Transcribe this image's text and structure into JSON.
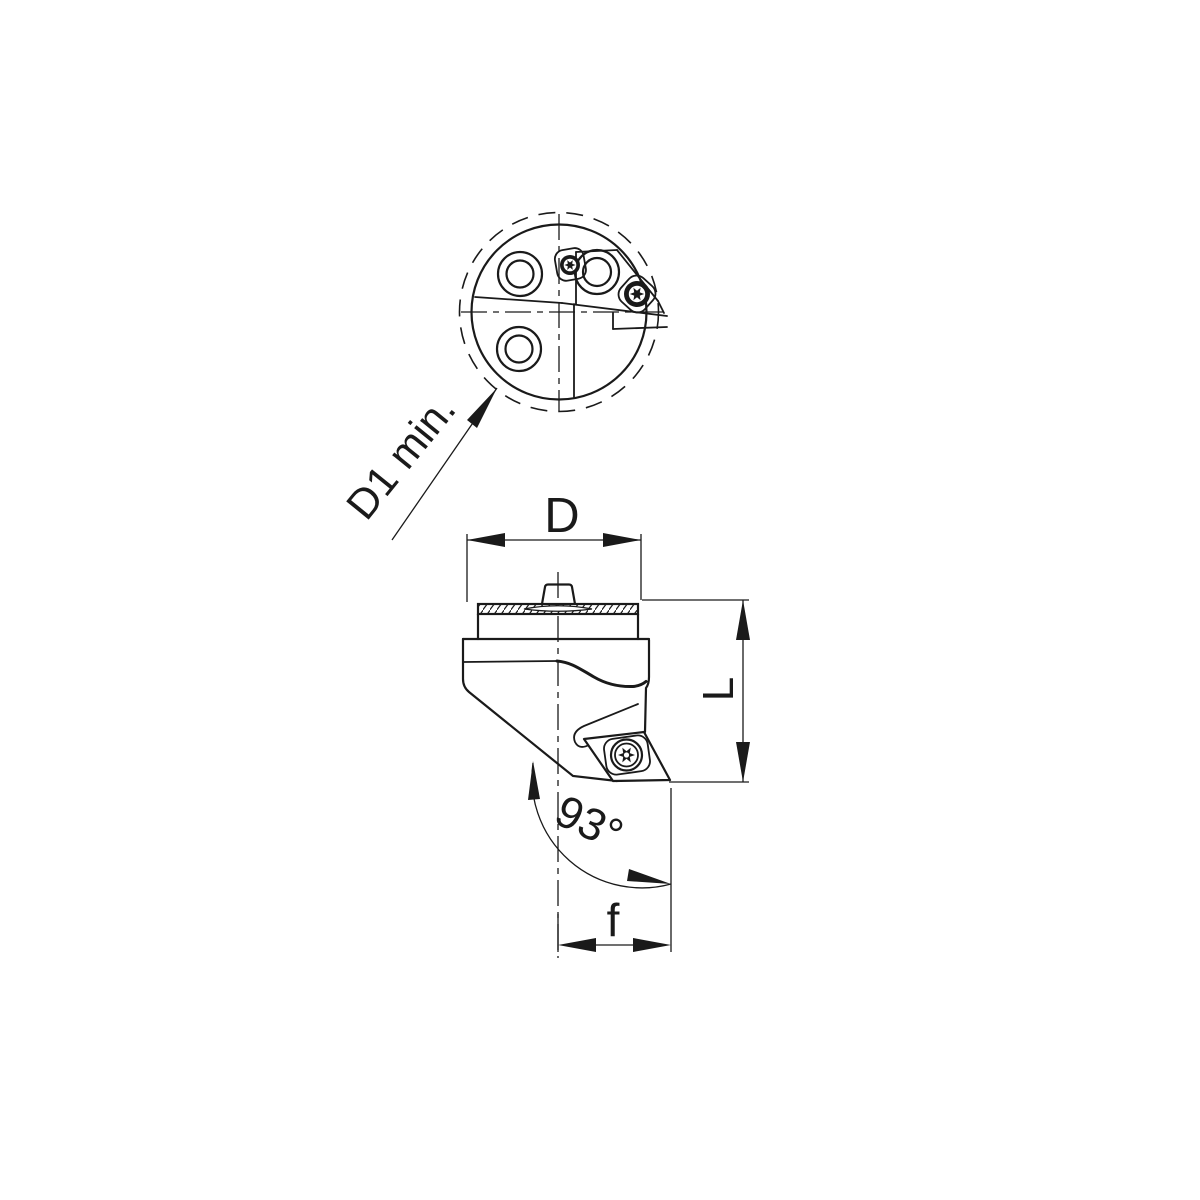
{
  "labels": {
    "d1_min": "D1 min.",
    "diameter": "D",
    "length": "L",
    "angle": "93°",
    "feed": "f"
  },
  "colors": {
    "line": "#1a1a1a",
    "background": "#ffffff"
  }
}
